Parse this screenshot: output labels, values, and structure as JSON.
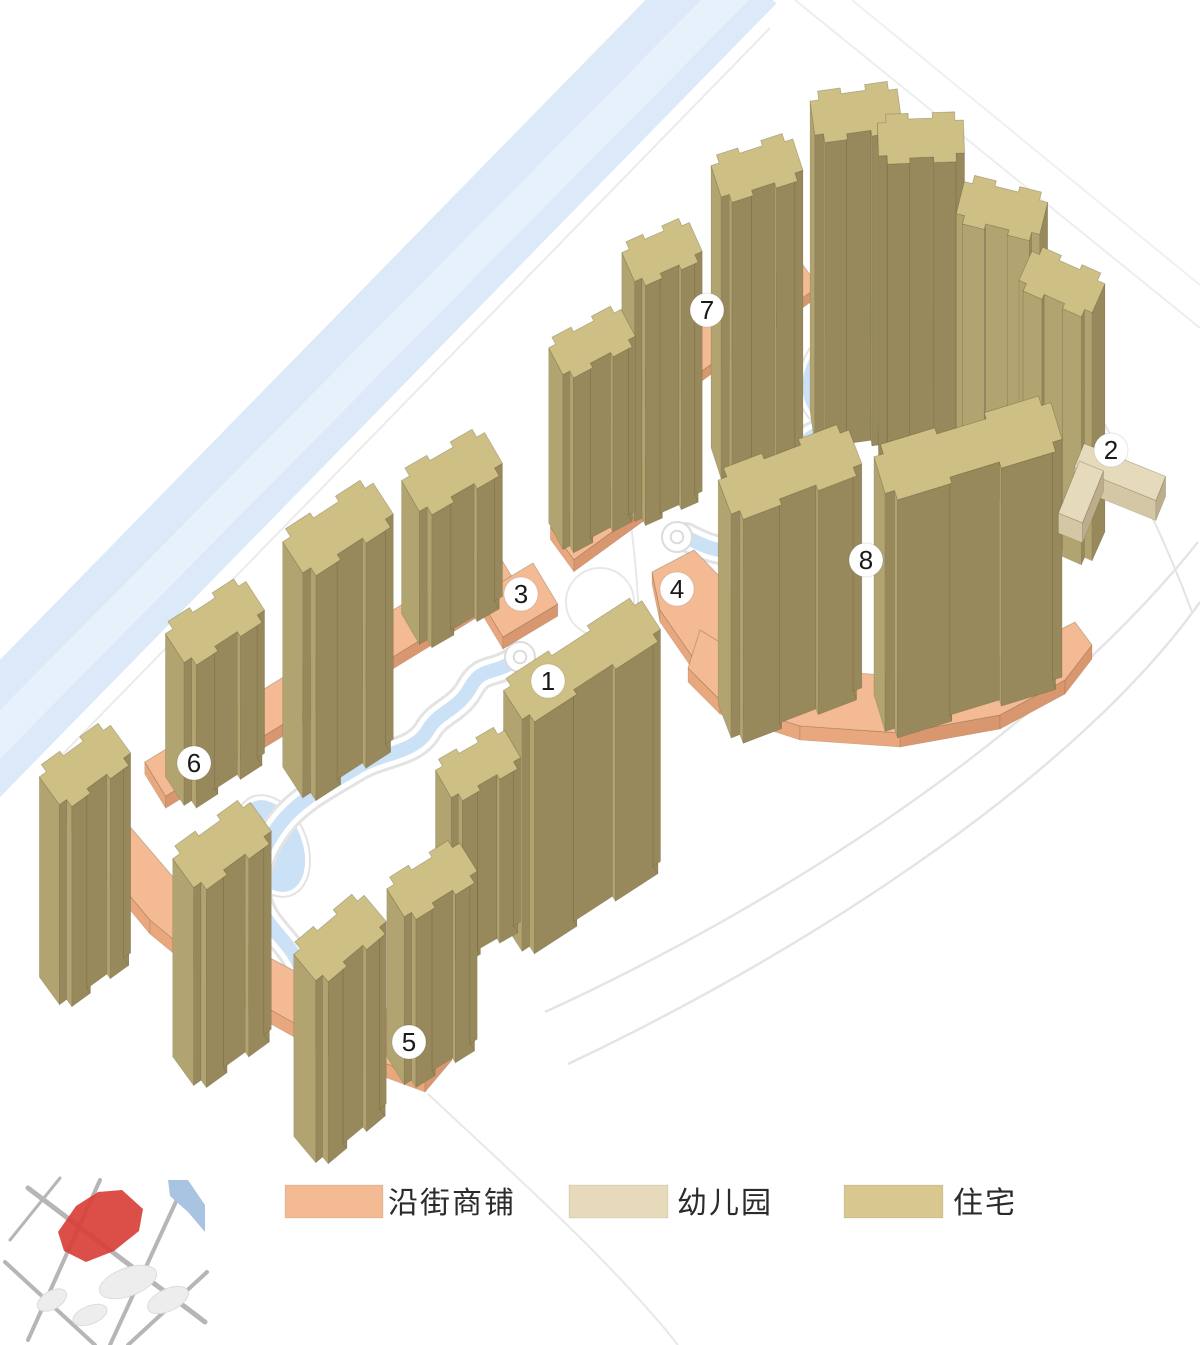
{
  "figure": {
    "kind": "residential masterplan axonometric diagram",
    "background": "#ffffff"
  },
  "legend": {
    "items": [
      {
        "key": "street-shops",
        "label": "沿街商铺",
        "color": "#f3ba93"
      },
      {
        "key": "kindergarten",
        "label": "幼儿园",
        "color": "#e6dabb"
      },
      {
        "key": "residential",
        "label": "住宅",
        "color": "#d8c78e"
      }
    ]
  },
  "markers": [
    {
      "label": "1",
      "x": 548,
      "y": 681
    },
    {
      "label": "2",
      "x": 1111,
      "y": 450
    },
    {
      "label": "3",
      "x": 521,
      "y": 594
    },
    {
      "label": "4",
      "x": 677,
      "y": 589
    },
    {
      "label": "5",
      "x": 409,
      "y": 1042
    },
    {
      "label": "6",
      "x": 194,
      "y": 763
    },
    {
      "label": "7",
      "x": 707,
      "y": 310
    },
    {
      "label": "8",
      "x": 866,
      "y": 560
    }
  ],
  "palette": {
    "residential": {
      "top": "#cec085",
      "light": "#b2a470",
      "dark": "#97895b"
    },
    "shops": {
      "top": "#f3ba93",
      "light": "#e9a77e",
      "dark": "#d9976f"
    },
    "kindergarten": {
      "top": "#e5dabb",
      "light": "#d4c7a5",
      "dark": "#bcae8d"
    },
    "water": "#cbe1f6",
    "river": "#dbe9f8",
    "road": "#e4e4e4",
    "marker_fill": "#ffffff",
    "marker_text": "#1a1a1a",
    "inset_road": "#b6b6b6",
    "inset_site": "#d84038",
    "inset_water": "#a9c4e3",
    "inset_building": "#ededed"
  }
}
